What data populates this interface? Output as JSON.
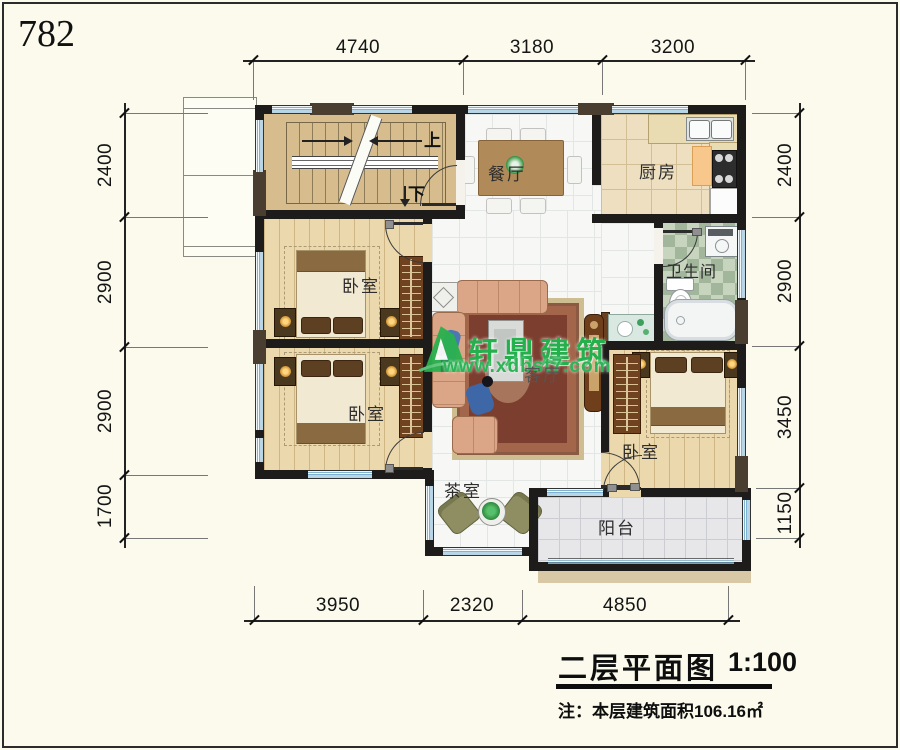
{
  "page": {
    "number": "782"
  },
  "watermark": {
    "brand": "轩鼎建筑",
    "url": "www.xdbst7.com",
    "color": "#23b04d"
  },
  "title_block": {
    "title": "二层平面图",
    "scale": "1:100",
    "note": "注：本层建筑面积106.16㎡"
  },
  "dimensions": {
    "top": [
      "4740",
      "3180",
      "3200"
    ],
    "bottom": [
      "3950",
      "2320",
      "4850"
    ],
    "left": [
      "2400",
      "2900",
      "2900",
      "1700"
    ],
    "right": [
      "2400",
      "2900",
      "3450",
      "1150"
    ]
  },
  "rooms": {
    "dining": "餐厅",
    "kitchen": "厨房",
    "bathroom": "卫生间",
    "bedroom1": "卧室",
    "bedroom2": "卧室",
    "bedroom3": "卧室",
    "living": "客厅",
    "tea": "茶室",
    "balcony": "阳台"
  },
  "stairs": {
    "up": "上",
    "down": "下"
  }
}
